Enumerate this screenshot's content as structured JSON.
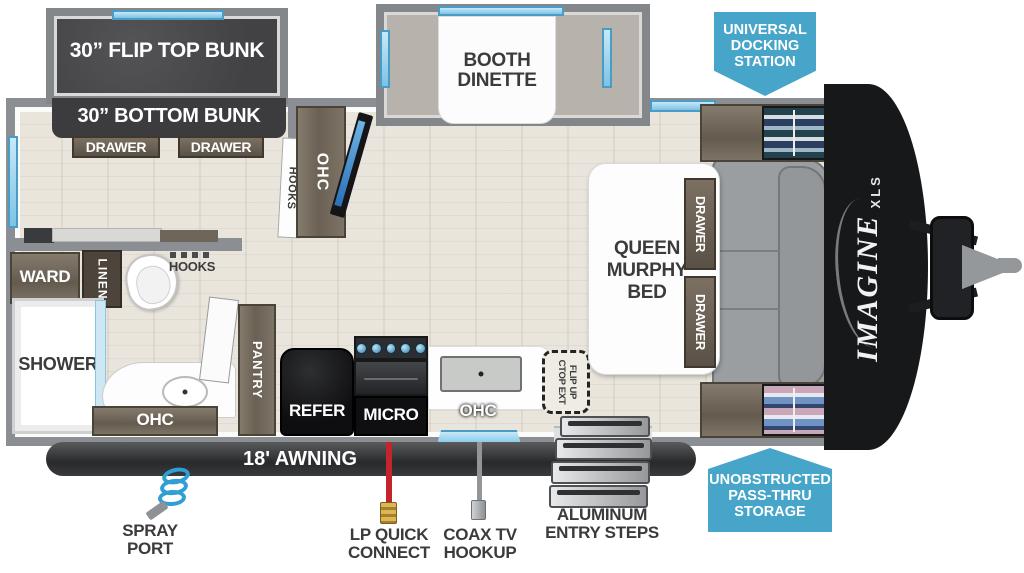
{
  "title": "Imagine XLS travel trailer floorplan",
  "brand": {
    "name": "IMAGINE",
    "sub": "XLS"
  },
  "colors": {
    "badge_blue": "#46a5c9",
    "window_blue": "#7cc3e6",
    "lp_red": "#c2262c",
    "hose_blue": "#2f9fd6",
    "awning_dark": "#2f3032"
  },
  "badges": {
    "universal_docking_station": {
      "line1": "UNIVERSAL",
      "line2": "DOCKING",
      "line3": "STATION"
    },
    "unobstructed_pass_thru": {
      "line1": "UNOBSTRUCTED",
      "line2": "PASS-THRU",
      "line3": "STORAGE"
    }
  },
  "rooms": {
    "flip_top_bunk": "30” FLIP TOP BUNK",
    "bottom_bunk": "30” BOTTOM BUNK",
    "bunk_drawer_left": "DRAWER",
    "bunk_drawer_right": "DRAWER",
    "booth_dinette": {
      "line1": "BOOTH",
      "line2": "DINETTE"
    },
    "queen_murphy_bed": {
      "line1": "QUEEN",
      "line2": "MURPHY",
      "line3": "BED"
    },
    "bed_drawer_upper": "DRAWER",
    "bed_drawer_lower": "DRAWER",
    "ward": "WARD",
    "linen": "LINEN",
    "shower": "SHOWER",
    "hooks_bunk": "HOOKS",
    "hooks_bath": "HOOKS",
    "ohc_entertainment": "OHC",
    "ohc_bath": "OHC",
    "ohc_kitchen": "OHC",
    "pantry": "PANTRY",
    "refer": "REFER",
    "micro": "MICRO",
    "flip_up_ctop": {
      "line1": "FLIP UP",
      "line2": "CTOP EXT"
    }
  },
  "exterior": {
    "awning": "18' AWNING",
    "spray_port": {
      "line1": "SPRAY",
      "line2": "PORT"
    },
    "lp_quick_connect": {
      "line1": "LP QUICK",
      "line2": "CONNECT"
    },
    "coax_tv_hookup": {
      "line1": "COAX TV",
      "line2": "HOOKUP"
    },
    "entry_steps": {
      "line1": "ALUMINUM",
      "line2": "ENTRY STEPS"
    }
  }
}
